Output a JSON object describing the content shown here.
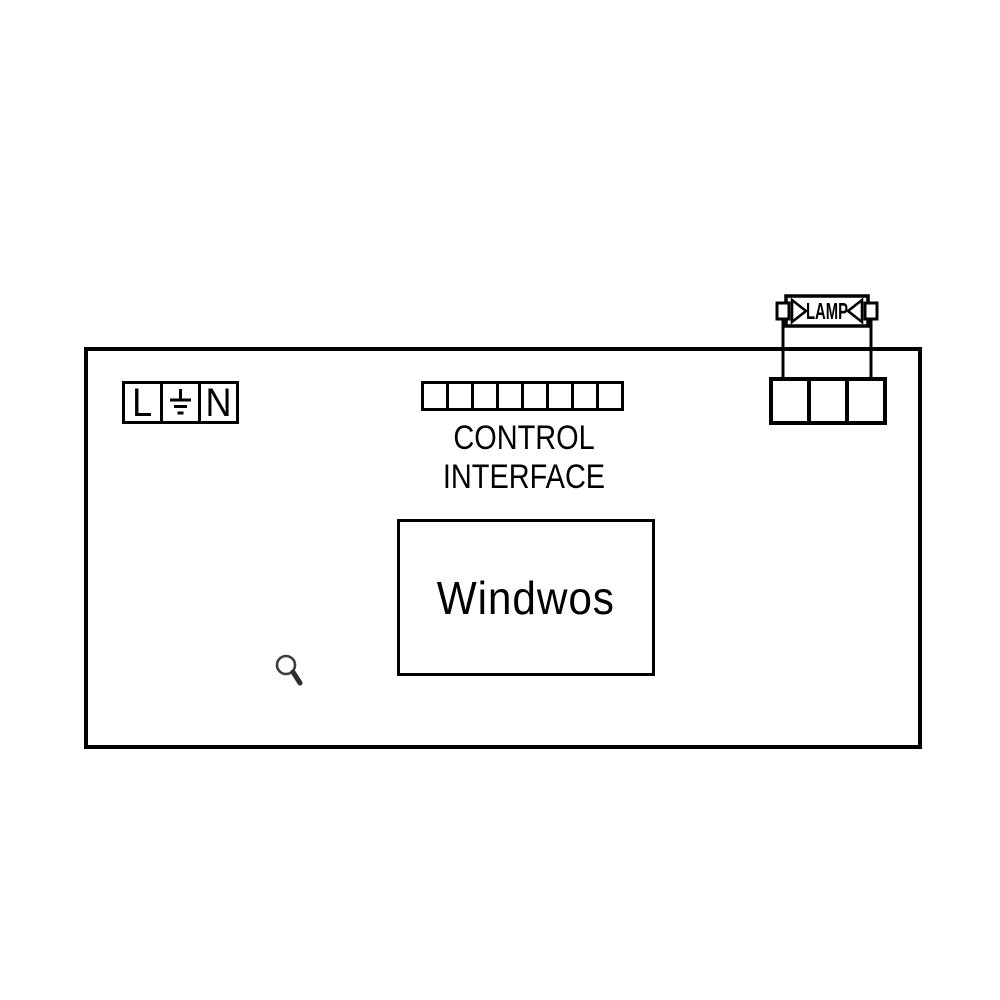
{
  "colors": {
    "background": "#ffffff",
    "line": "#000000",
    "search_icon": "#3c3c3c"
  },
  "diagram": {
    "device": {
      "power_terminal": {
        "live_label": "L",
        "neutral_label": "N",
        "earth_icon": "earth-ground-icon",
        "cell_count": 3
      },
      "control_interface": {
        "pin_count": 8,
        "label_line1": "CONTROL",
        "label_line2": "INTERFACE"
      },
      "module": {
        "label": "Windwos"
      },
      "search_icon": "search-icon"
    },
    "lamp": {
      "label": "LAMP",
      "terminal_cell_count": 3
    }
  }
}
